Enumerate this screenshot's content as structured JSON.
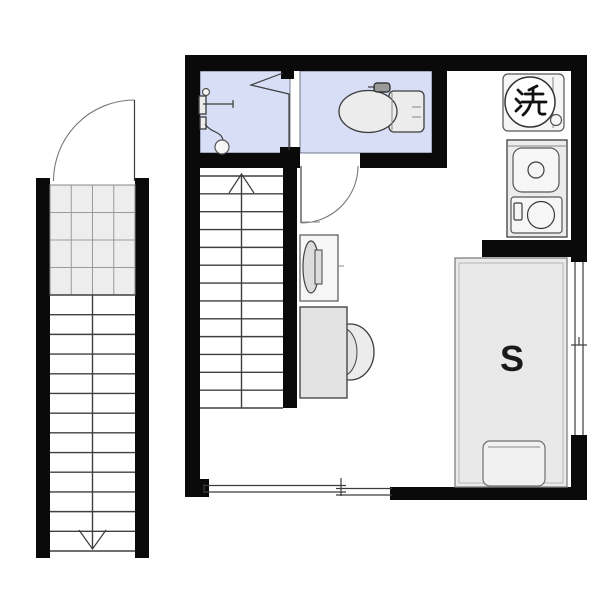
{
  "labels": {
    "bed_size": "S",
    "washer_glyph": "洗"
  },
  "colors": {
    "wall": "#0a0a0a",
    "wet_room_floor": "#d7def6",
    "fixture_fill": "#ececec",
    "fixture_fill_light": "#f6f6f6",
    "furniture_fill": "#e3e3e3",
    "outline": "#3c3c3c",
    "soft_outline": "#888888",
    "background": "#ffffff",
    "text": "#1a1a1a"
  },
  "stairs": {
    "interior": {
      "steps": 13,
      "direction": "up"
    },
    "exterior": {
      "steps": 13,
      "direction": "down",
      "landing_grid": {
        "rows": 4,
        "cols": 4
      }
    }
  }
}
